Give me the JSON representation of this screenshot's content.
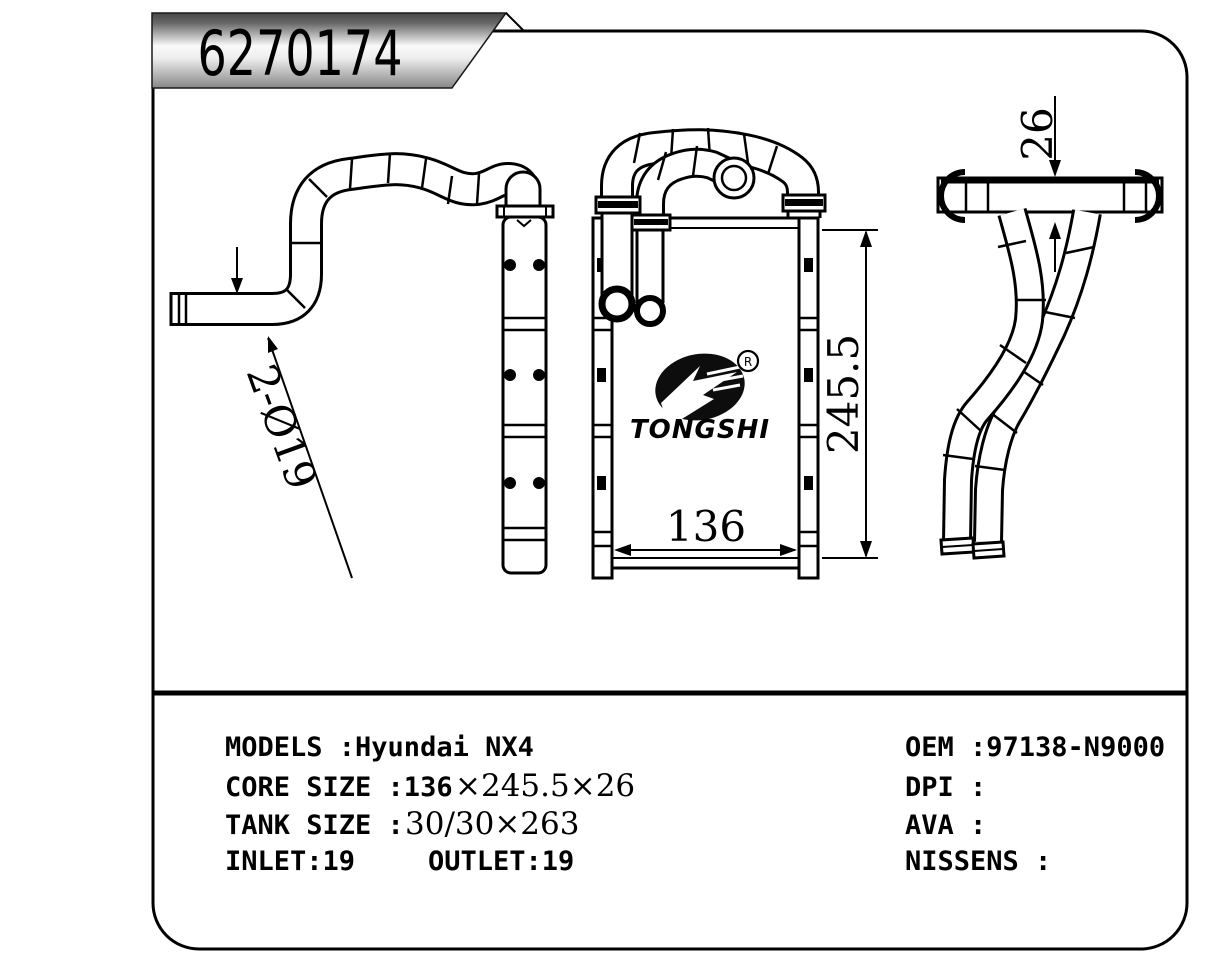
{
  "banner": {
    "part_number": "6270174"
  },
  "drawing": {
    "dim_pipe": "2-Ø19",
    "dim_width": "136",
    "dim_height": "245.5",
    "dim_depth": "26",
    "logo": {
      "wordmark": "TONGSHI",
      "registered": "R"
    }
  },
  "specs": {
    "models": "MODELS :Hyundai NX4",
    "core_label": "CORE SIZE :136",
    "core_value": "×245.5×26",
    "tank_label": "TANK SIZE :",
    "tank_value": "30/30×263",
    "inlet": "INLET:19",
    "outlet": "OUTLET:19",
    "oem": "OEM :97138-N9000",
    "dpi": "DPI :",
    "ava": "AVA :",
    "nissens": "NISSENS :"
  }
}
